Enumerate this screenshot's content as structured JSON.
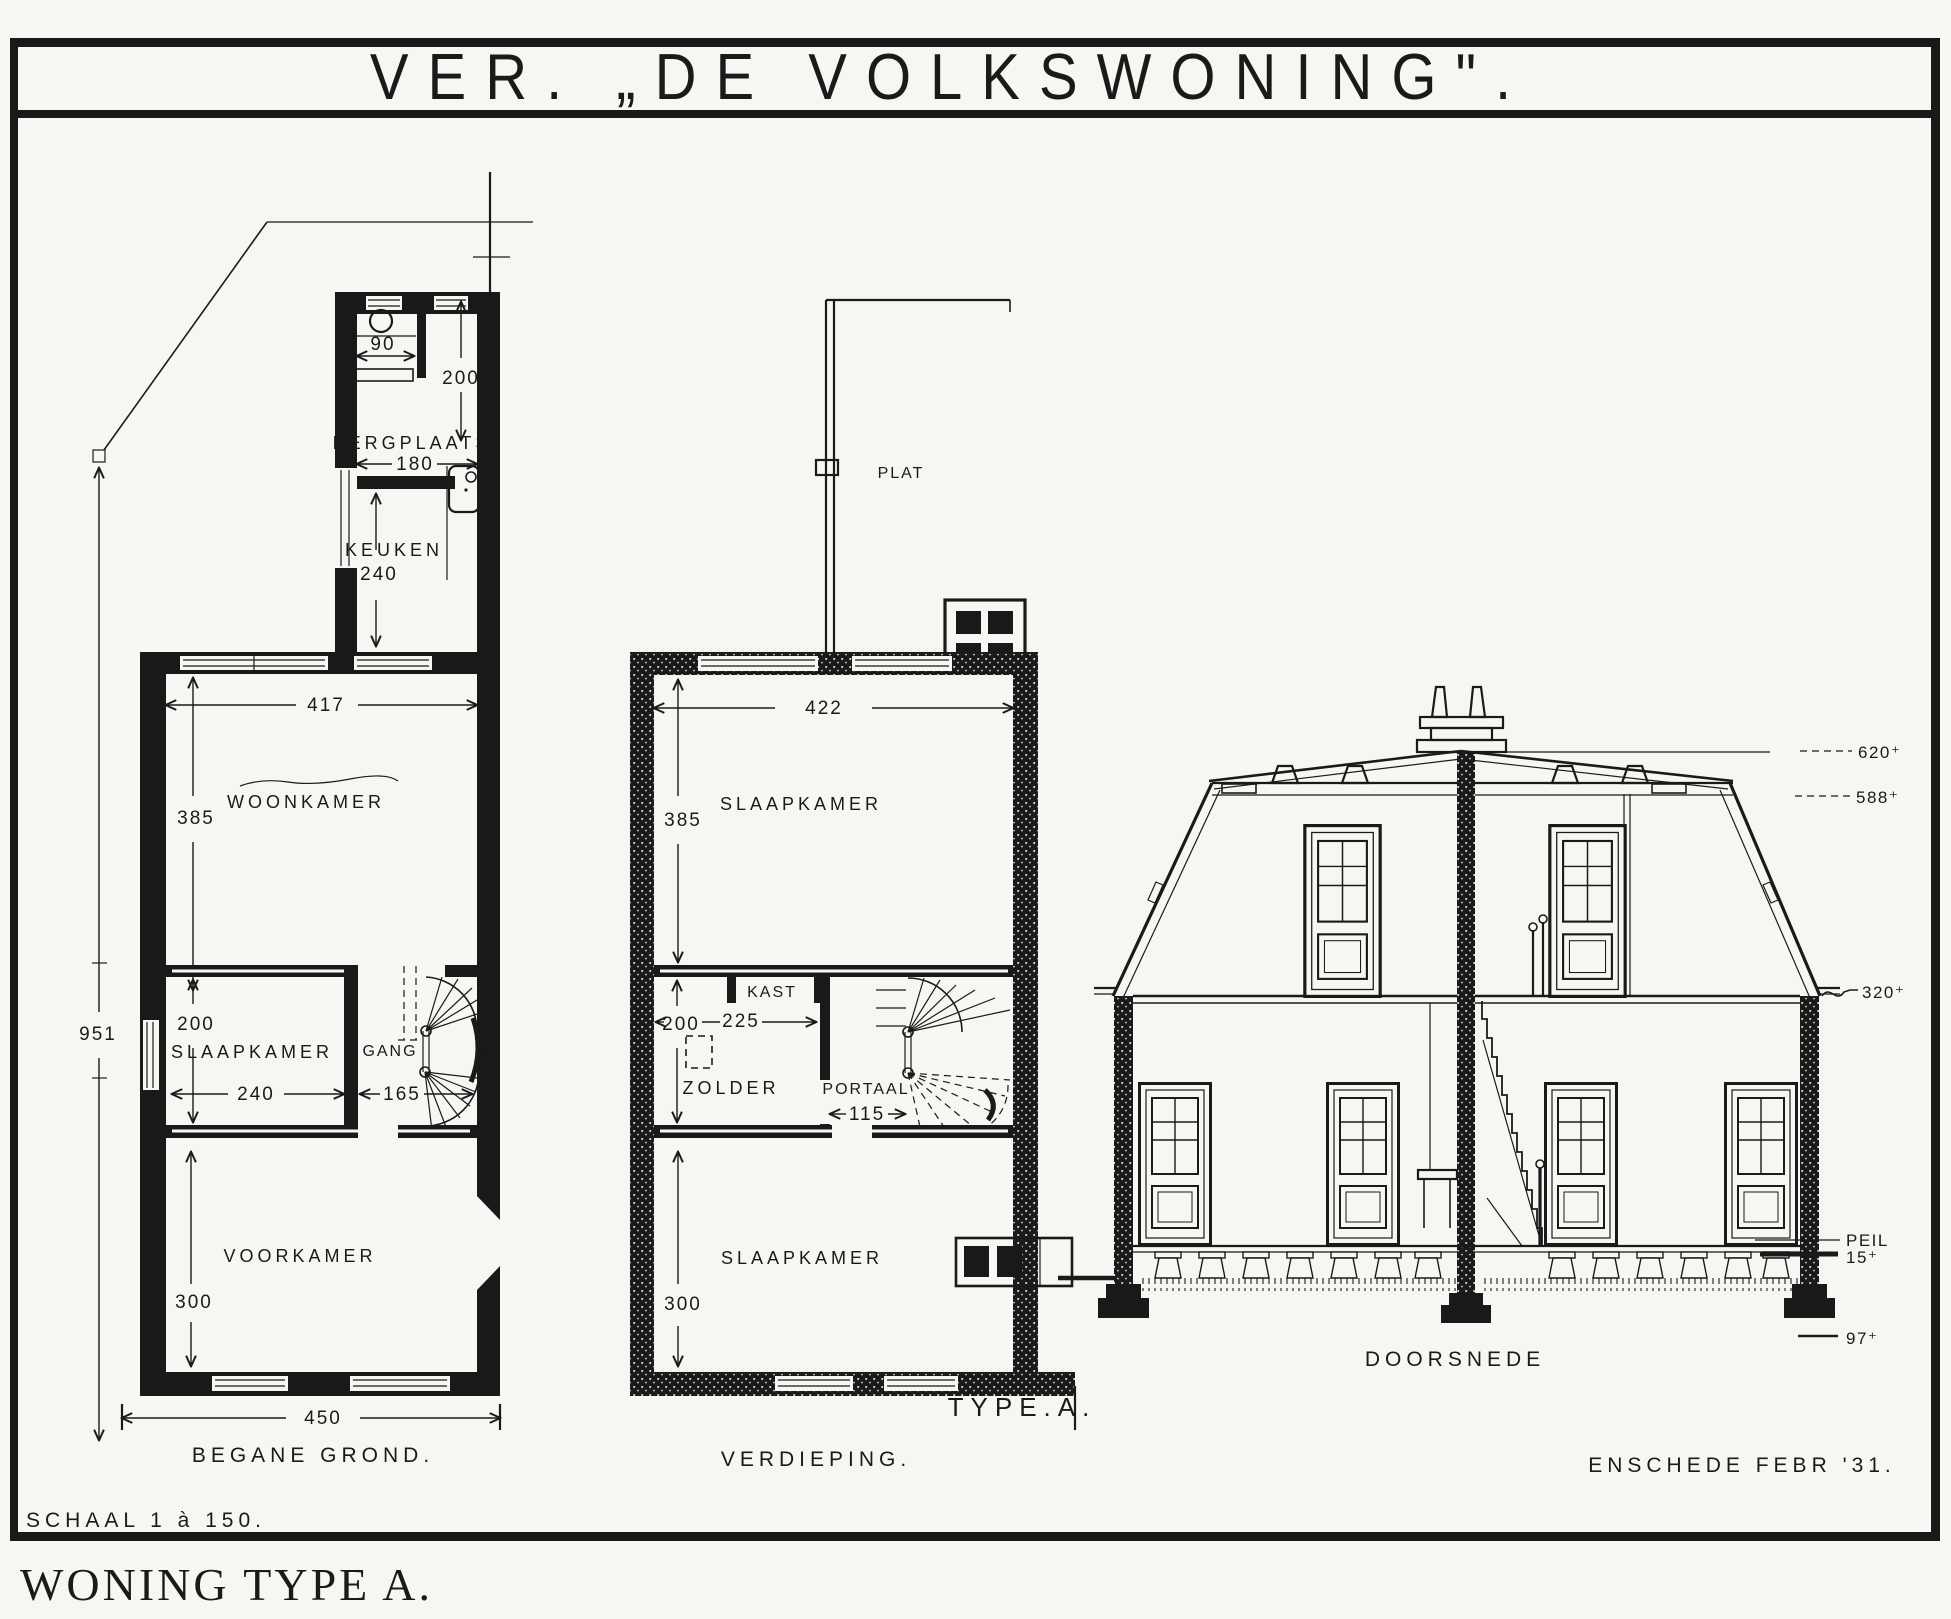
{
  "page": {
    "title": "VER. „DE VOLKSWONING\".",
    "caption": "WONING TYPE A.",
    "scale_note": "SCHAAL 1 à 150.",
    "location_date": "ENSCHEDE FEBR '31."
  },
  "ground_floor": {
    "label": "BEGANE GROND.",
    "rooms": {
      "bergplaats": "BERGPLAATS",
      "keuken": "KEUKEN",
      "woonkamer": "WOONKAMER",
      "slaapkamer": "SLAAPKAMER",
      "gang": "GANG",
      "voorkamer": "VOORKAMER"
    },
    "dims": {
      "wc_width": "90",
      "bergplaats_depth": "200",
      "bergplaats_width": "180",
      "keuken_depth": "240",
      "woonkamer_width": "417",
      "woonkamer_depth": "385",
      "slaapkamer_depth": "200",
      "slaapkamer_width": "240",
      "gang_width": "165",
      "voorkamer_depth": "300",
      "house_width": "450",
      "house_depth": "951"
    }
  },
  "verdieping": {
    "label": "VERDIEPING.",
    "type_label": "TYPE.A.",
    "rooms": {
      "plat": "PLAT",
      "slaapkamer_front": "SLAAPKAMER",
      "kast": "KAST",
      "zolder": "ZOLDER",
      "portaal": "PORTAAL",
      "slaapkamer_back": "SLAAPKAMER"
    },
    "dims": {
      "slaapkamer_width": "422",
      "slaapkamer_depth": "385",
      "zolder_depth": "200",
      "zolder_width": "225",
      "portaal_width": "115",
      "slaapkamer_back_depth": "300"
    }
  },
  "section": {
    "label": "DOORSNEDE",
    "elevations": {
      "ridge": "620⁺",
      "gutter": "588⁺",
      "floor1": "320⁺",
      "peil": "PEIL",
      "floor0": "15⁺",
      "foundation": "97⁺"
    }
  }
}
